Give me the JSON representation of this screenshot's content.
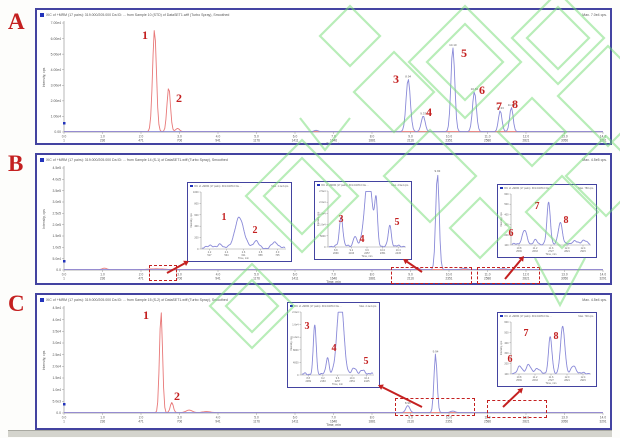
{
  "figure": {
    "background": "#fdfdfb",
    "panel_border_color": "#4343a0",
    "watermark_color": "#74dd74",
    "annotation_color": "#c42020",
    "trace_red": "#e87878",
    "trace_blue": "#8a8ad8",
    "axis_color": "#999999"
  },
  "axis": {
    "xlabel": "Time, min",
    "ylabel": "Intensity, cps",
    "time_ticks": [
      "0.0",
      "1.0",
      "2.0",
      "3.0",
      "4.0",
      "5.0",
      "6.0",
      "7.0",
      "8.0",
      "9.0",
      "10.0",
      "11.0",
      "12.0",
      "13.0",
      "14.0"
    ],
    "scan_ticks": [
      "1",
      "236",
      "471",
      "706",
      "941",
      "1176",
      "1411",
      "1646",
      "1881",
      "2116",
      "2351",
      "2586",
      "2821",
      "3056",
      "3291"
    ],
    "t_max": 14
  },
  "panels": [
    {
      "label": "A",
      "header": "XIC of +MRM (17 pairs): 319.000/205.000 Da ID: ... from Sample 10 (STD) of DataSET1.wiff (Turbo Spray), Smoothed",
      "max_label": "Max. 7.0e4 cps.",
      "yticks": [
        "7.00e4",
        "6.00e4",
        "5.00e4",
        "4.00e4",
        "3.00e4",
        "2.00e4",
        "1.00e4",
        "0.00"
      ],
      "annotations": [
        {
          "n": "1",
          "x": 108,
          "y": 19
        },
        {
          "n": "2",
          "x": 142,
          "y": 82
        },
        {
          "n": "3",
          "x": 359,
          "y": 63
        },
        {
          "n": "4",
          "x": 392,
          "y": 96
        },
        {
          "n": "5",
          "x": 427,
          "y": 37
        },
        {
          "n": "6",
          "x": 445,
          "y": 74
        },
        {
          "n": "7",
          "x": 462,
          "y": 90
        },
        {
          "n": "8",
          "x": 478,
          "y": 88
        }
      ],
      "insets": [],
      "dashed_boxes": [],
      "arrows": []
    },
    {
      "label": "B",
      "header": "XIC of +MRM (17 pairs): 319.000/205.000 Da ID: ... from Sample 14 (S-1) of DataSET1.wiff (Turbo Spray), Smoothed",
      "max_label": "Max. 4.5e5 cps.",
      "yticks": [
        "4.5e5",
        "4.0e5",
        "3.5e5",
        "3.0e5",
        "2.5e5",
        "2.0e5",
        "1.5e5",
        "1.0e5",
        "5.0e4",
        "0.0"
      ],
      "annotations": [],
      "insets": [
        {
          "x": 150,
          "y": 27,
          "w": 105,
          "h": 80,
          "header": "XIC of +MRM (17 pairs): 319.0/205.0 Da ...",
          "max_label": "Max. 1.1e3 cps.",
          "yticks": [
            "1000",
            "800",
            "600",
            "400",
            "200",
            "0"
          ],
          "xticks": [
            "2.2",
            "2.4",
            "2.6",
            "2.8",
            "3.0"
          ],
          "xscans": [
            "517",
            "564",
            "611",
            "658",
            "705"
          ],
          "annotations": [
            {
              "n": "1",
              "x": 36,
              "y": 30
            },
            {
              "n": "2",
              "x": 67,
              "y": 43
            }
          ]
        },
        {
          "x": 277,
          "y": 26,
          "w": 98,
          "h": 79,
          "header": "XIC of +MRM (17 pairs): 319.0/205.0 Da ...",
          "max_label": "Max. 2.9e4 cps.",
          "yticks": [
            "2.5e4",
            "2.0e4",
            "1.5e4",
            "1.0e4",
            "5000",
            "0"
          ],
          "xticks": [
            "8.8",
            "9.2",
            "9.6",
            "10.0",
            "10.4"
          ],
          "xscans": [
            "2069",
            "2163",
            "2257",
            "2351",
            "2445"
          ],
          "annotations": [
            {
              "n": "3",
              "x": 26,
              "y": 33
            },
            {
              "n": "4",
              "x": 47,
              "y": 53
            },
            {
              "n": "5",
              "x": 82,
              "y": 36
            }
          ]
        },
        {
          "x": 460,
          "y": 29,
          "w": 100,
          "h": 74,
          "header": "XIC of +MRM (17 pairs): 319.0/205.0 Da ...",
          "max_label": "Max. 780 cps.",
          "yticks": [
            "600",
            "500",
            "400",
            "300",
            "200",
            "100"
          ],
          "xticks": [
            "10.8",
            "11.2",
            "11.6",
            "12.0",
            "12.4"
          ],
          "xscans": [
            "2539",
            "2633",
            "2727",
            "2821",
            "2915"
          ],
          "annotations": [
            {
              "n": "6",
              "x": 13,
              "y": 44
            },
            {
              "n": "7",
              "x": 39,
              "y": 17
            },
            {
              "n": "8",
              "x": 68,
              "y": 31
            }
          ]
        }
      ],
      "dashed_boxes": [
        {
          "x": 112,
          "y": 110,
          "w": 28,
          "h": 16
        },
        {
          "x": 354,
          "y": 112,
          "w": 81,
          "h": 17
        },
        {
          "x": 440,
          "y": 112,
          "w": 63,
          "h": 17
        }
      ],
      "arrows": [
        {
          "x1": 130,
          "y1": 118,
          "x2": 152,
          "y2": 106
        },
        {
          "x1": 385,
          "y1": 117,
          "x2": 366,
          "y2": 104
        },
        {
          "x1": 468,
          "y1": 124,
          "x2": 487,
          "y2": 101
        }
      ]
    },
    {
      "label": "C",
      "header": "XIC of +MRM (17 pairs): 319.000/205.000 Da ID: ... from Sample 15 (S-2) of DataSET1.wiff (Turbo Spray), Smoothed",
      "max_label": "Max. 4.5e4 cps.",
      "yticks": [
        "4.5e4",
        "4.0e4",
        "3.5e4",
        "3.0e4",
        "2.5e4",
        "2.0e4",
        "1.5e4",
        "1.0e4",
        "5.0e3",
        "0.0"
      ],
      "annotations": [
        {
          "n": "1",
          "x": 109,
          "y": 14
        },
        {
          "n": "2",
          "x": 140,
          "y": 95
        }
      ],
      "insets": [
        {
          "x": 250,
          "y": 7,
          "w": 93,
          "h": 86,
          "header": "XIC of +MRM (17 pairs): 319.0/205.0 Da ...",
          "max_label": "Max. 2.1e4 cps.",
          "yticks": [
            "2.0e4",
            "1.6e4",
            "1.2e4",
            "8000",
            "4000",
            "0"
          ],
          "xticks": [
            "8.8",
            "9.2",
            "9.6",
            "10.0",
            "10.4"
          ],
          "xscans": [
            "2069",
            "2163",
            "2257",
            "2351",
            "2445"
          ],
          "annotations": [
            {
              "n": "3",
              "x": 19,
              "y": 19
            },
            {
              "n": "4",
              "x": 46,
              "y": 41
            },
            {
              "n": "5",
              "x": 78,
              "y": 54
            }
          ]
        },
        {
          "x": 460,
          "y": 17,
          "w": 100,
          "h": 75,
          "header": "XIC of +MRM (17 pairs): 319.0/205.0 Da ...",
          "max_label": "Max. 700 cps.",
          "yticks": [
            "600",
            "500",
            "400",
            "300",
            "200",
            "100"
          ],
          "xticks": [
            "10.8",
            "11.2",
            "11.6",
            "12.0",
            "12.4"
          ],
          "xscans": [
            "2539",
            "2633",
            "2727",
            "2821",
            "2915"
          ],
          "annotations": [
            {
              "n": "6",
              "x": 12,
              "y": 42
            },
            {
              "n": "7",
              "x": 28,
              "y": 16
            },
            {
              "n": "8",
              "x": 58,
              "y": 19
            }
          ]
        }
      ],
      "dashed_boxes": [
        {
          "x": 358,
          "y": 103,
          "w": 80,
          "h": 18
        },
        {
          "x": 450,
          "y": 105,
          "w": 60,
          "h": 18
        }
      ],
      "arrows": [
        {
          "x1": 385,
          "y1": 112,
          "x2": 341,
          "y2": 90
        },
        {
          "x1": 466,
          "y1": 112,
          "x2": 486,
          "y2": 93
        }
      ]
    }
  ],
  "chart_data": [
    {
      "type": "line",
      "panel": "A",
      "x_range": [
        0,
        14
      ],
      "xlabel": "Time, min",
      "ylabel": "Intensity, cps",
      "legend": "off",
      "series": [
        {
          "name": "red-trace-standards-1-2",
          "color_key": "trace_red",
          "peaks": [
            {
              "n": "1",
              "t": 2.35,
              "h": 0.97,
              "w": 0.05
            },
            {
              "n": "2",
              "t": 2.72,
              "h": 0.42,
              "w": 0.045
            },
            {
              "t": 2.95,
              "h": 0.03,
              "w": 0.05
            }
          ]
        },
        {
          "name": "blue-trace-standards-3-8",
          "color_key": "trace_blue",
          "peaks": [
            {
              "t": 6.55,
              "h": 0.012,
              "w": 0.05
            },
            {
              "n": "3",
              "t": 8.94,
              "h": 0.5,
              "w": 0.055,
              "rt": "8.94"
            },
            {
              "n": "4",
              "t": 9.33,
              "h": 0.15,
              "w": 0.05,
              "rt": "9.33"
            },
            {
              "n": "5",
              "t": 10.1,
              "h": 0.8,
              "w": 0.05,
              "rt": "10.10"
            },
            {
              "n": "6",
              "t": 10.66,
              "h": 0.38,
              "w": 0.05,
              "rt": "10.66"
            },
            {
              "n": "7",
              "t": 11.33,
              "h": 0.2,
              "w": 0.045,
              "rt": "11.33"
            },
            {
              "n": "8",
              "t": 11.62,
              "h": 0.23,
              "w": 0.045,
              "rt": "11.62"
            }
          ]
        }
      ],
      "insets": []
    },
    {
      "type": "line",
      "panel": "B",
      "x_range": [
        0,
        14
      ],
      "xlabel": "Time, min",
      "ylabel": "Intensity, cps",
      "legend": "off",
      "series": [
        {
          "name": "red-trace",
          "color_key": "trace_red",
          "peaks": [
            {
              "t": 1.05,
              "h": 0.015,
              "w": 0.06
            },
            {
              "t": 2.4,
              "h": 0.008,
              "w": 0.2
            }
          ]
        },
        {
          "name": "blue-trace",
          "color_key": "trace_blue",
          "peaks": [
            {
              "t": 9.2,
              "h": 0.012,
              "w": 0.05
            },
            {
              "t": 9.7,
              "h": 0.98,
              "w": 0.045,
              "rt": "9.93"
            },
            {
              "t": 10.4,
              "h": 0.01,
              "w": 0.08
            },
            {
              "t": 11.4,
              "h": 0.008,
              "w": 0.1
            }
          ]
        }
      ],
      "insets": [
        {
          "peaks": [
            {
              "p": 0.1,
              "h": 0.06,
              "w": 0.03
            },
            {
              "p": 0.22,
              "h": 0.08,
              "w": 0.025
            },
            {
              "n": "1",
              "p": 0.45,
              "h": 0.55,
              "w": 0.055
            },
            {
              "n": "2",
              "p": 0.65,
              "h": 0.14,
              "w": 0.03
            },
            {
              "p": 0.88,
              "h": 0.11,
              "w": 0.035
            }
          ]
        },
        {
          "peaks": [
            {
              "n": "3",
              "p": 0.16,
              "h": 0.55,
              "w": 0.022
            },
            {
              "n": "4",
              "p": 0.34,
              "h": 0.18,
              "w": 0.022
            },
            {
              "p": 0.52,
              "h": 1.3,
              "w": 0.05,
              "clip": true
            },
            {
              "p": 0.62,
              "h": 0.75,
              "w": 0.018
            },
            {
              "n": "5",
              "p": 0.8,
              "h": 0.38,
              "w": 0.02
            }
          ]
        },
        {
          "peaks": [
            {
              "n": "6",
              "p": 0.16,
              "h": 0.28,
              "w": 0.03
            },
            {
              "p": 0.3,
              "h": 0.08,
              "w": 0.025
            },
            {
              "n": "7",
              "p": 0.47,
              "h": 0.85,
              "w": 0.022
            },
            {
              "n": "8",
              "p": 0.62,
              "h": 0.45,
              "w": 0.026
            },
            {
              "p": 0.8,
              "h": 0.07,
              "w": 0.03
            },
            {
              "p": 0.92,
              "h": 0.09,
              "w": 0.03
            }
          ]
        }
      ]
    },
    {
      "type": "line",
      "panel": "C",
      "x_range": [
        0,
        14
      ],
      "xlabel": "Time, min",
      "ylabel": "Intensity, cps",
      "legend": "off",
      "series": [
        {
          "name": "red-trace",
          "color_key": "trace_red",
          "peaks": [
            {
              "n": "1",
              "t": 2.52,
              "h": 1.0,
              "w": 0.04
            },
            {
              "n": "2",
              "t": 2.8,
              "h": 0.1,
              "w": 0.04
            },
            {
              "t": 3.25,
              "h": 0.025,
              "w": 0.08
            },
            {
              "t": 3.7,
              "h": 0.01,
              "w": 0.1
            }
          ]
        },
        {
          "name": "blue-trace",
          "color_key": "trace_blue",
          "peaks": [
            {
              "t": 8.93,
              "h": 0.07,
              "w": 0.05,
              "rt": "8.96"
            },
            {
              "t": 9.65,
              "h": 0.58,
              "w": 0.04,
              "rt": "9.94"
            },
            {
              "t": 10.1,
              "h": 0.015,
              "w": 0.06
            }
          ]
        }
      ],
      "insets": [
        {
          "peaks": [
            {
              "n": "3",
              "p": 0.18,
              "h": 0.8,
              "w": 0.02
            },
            {
              "n": "4",
              "p": 0.36,
              "h": 0.28,
              "w": 0.02
            },
            {
              "p": 0.54,
              "h": 1.3,
              "w": 0.045,
              "clip": true
            },
            {
              "n": "5",
              "p": 0.74,
              "h": 0.1,
              "w": 0.03
            },
            {
              "p": 0.86,
              "h": 0.06,
              "w": 0.03
            }
          ]
        },
        {
          "peaks": [
            {
              "n": "6",
              "p": 0.1,
              "h": 0.13,
              "w": 0.03
            },
            {
              "p": 0.21,
              "h": 0.17,
              "w": 0.028
            },
            {
              "p": 0.32,
              "h": 0.1,
              "w": 0.03
            },
            {
              "n": "7",
              "p": 0.49,
              "h": 0.72,
              "w": 0.022
            },
            {
              "n": "8",
              "p": 0.65,
              "h": 0.92,
              "w": 0.028
            },
            {
              "p": 0.79,
              "h": 0.14,
              "w": 0.03
            }
          ]
        }
      ]
    }
  ]
}
